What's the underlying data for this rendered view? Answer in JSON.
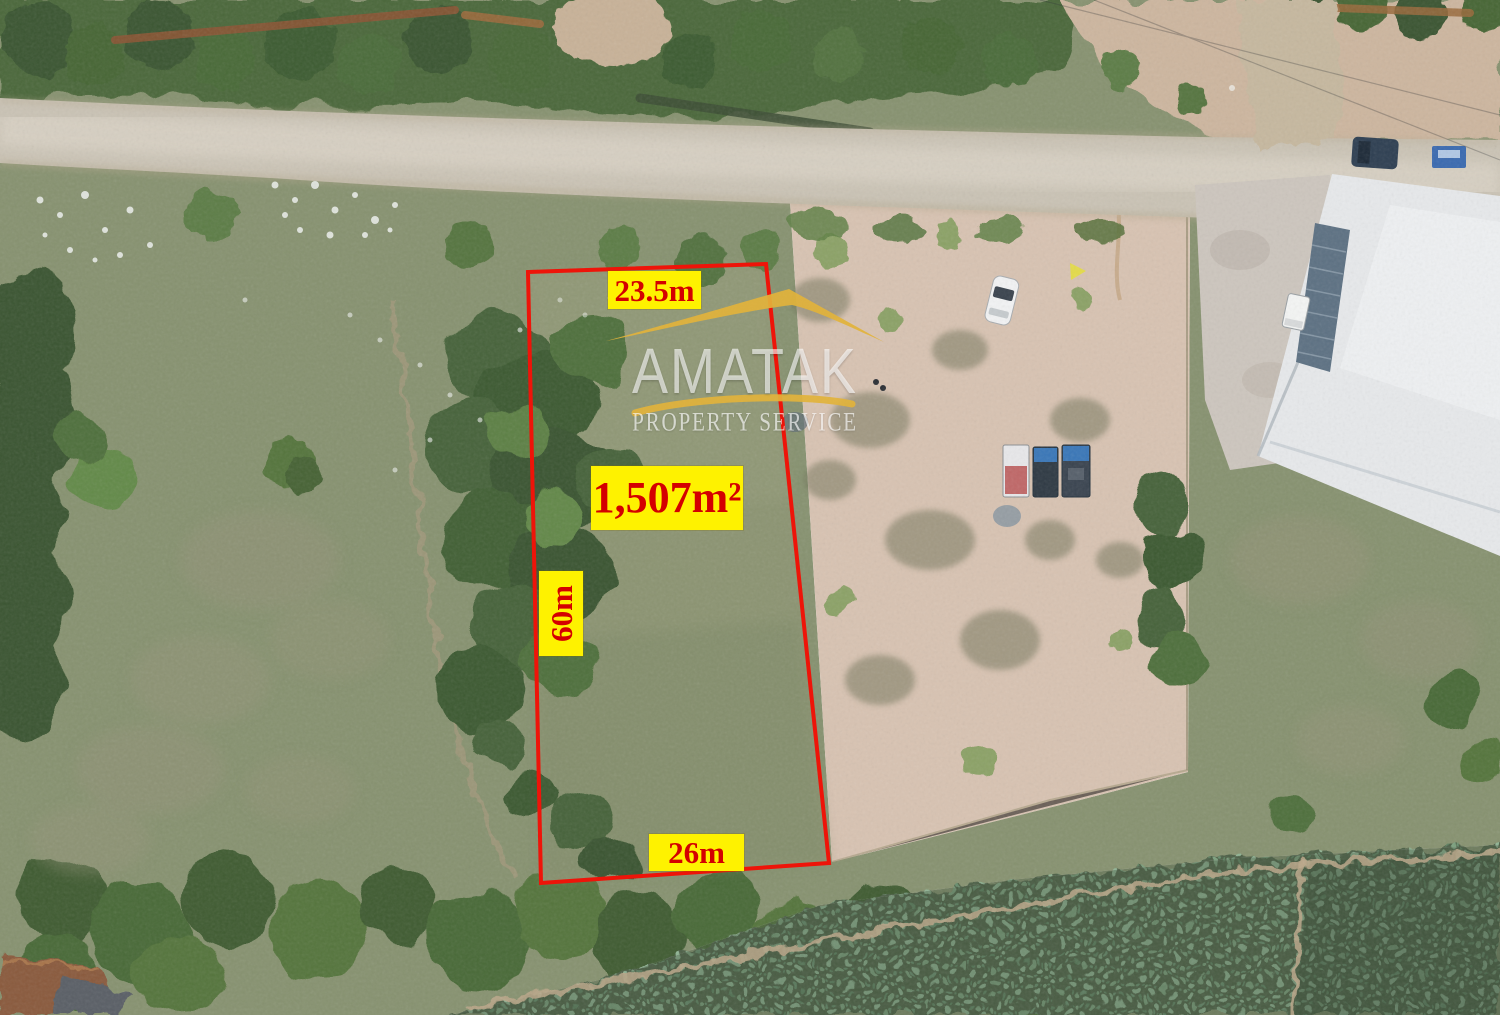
{
  "annotation_labels": {
    "top_width": "23.5m",
    "area": "1,507m²",
    "side_length": "60m",
    "bottom_width": "26m"
  },
  "watermark": {
    "brand": "AMATAK",
    "tagline": "PROPERTY SERVICE"
  },
  "colors": {
    "label_background": "#fef200",
    "label_text": "#d40000",
    "boundary_red": "#ee1409",
    "logo_gold": "#e2b33c",
    "watermark_white": "rgba(255,255,255,0.62)"
  }
}
